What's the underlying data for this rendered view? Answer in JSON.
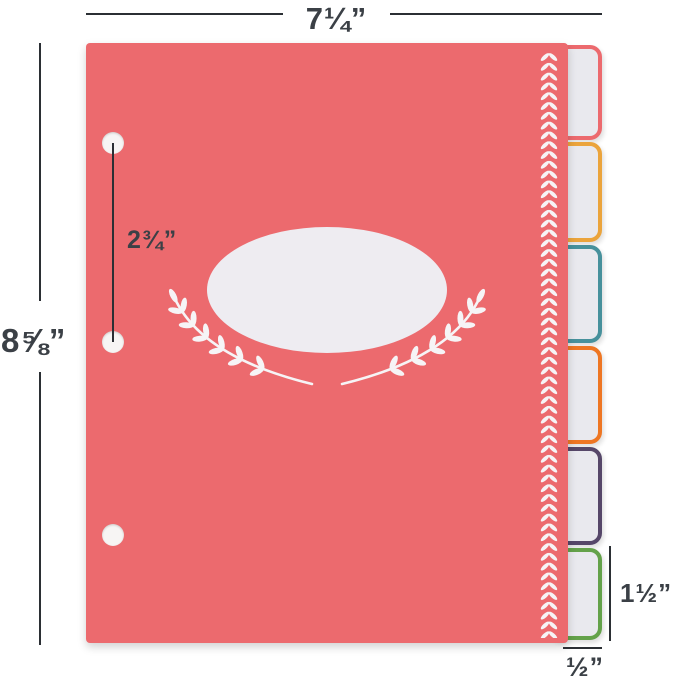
{
  "product": {
    "cover_color": "#ec6a6e",
    "label_oval_color": "#eeecf1",
    "tab_fill_color": "#e9e9ee",
    "decoration_color": "#f6f4f6",
    "tabs": [
      {
        "name": "tab-1",
        "color": "#ec6a6e"
      },
      {
        "name": "tab-2",
        "color": "#eba43c"
      },
      {
        "name": "tab-3",
        "color": "#47919c"
      },
      {
        "name": "tab-4",
        "color": "#ee7623"
      },
      {
        "name": "tab-5",
        "color": "#564769"
      },
      {
        "name": "tab-6",
        "color": "#64a24a"
      }
    ],
    "hole_count": 3
  },
  "annotations": {
    "width_label": "7¼”",
    "height_label": "8⅝”",
    "hole_spacing_label": "2¾”",
    "tab_height_label": "1½”",
    "tab_width_label": "½”",
    "line_color": "#2b2f34",
    "text_color": "#3b4046"
  }
}
